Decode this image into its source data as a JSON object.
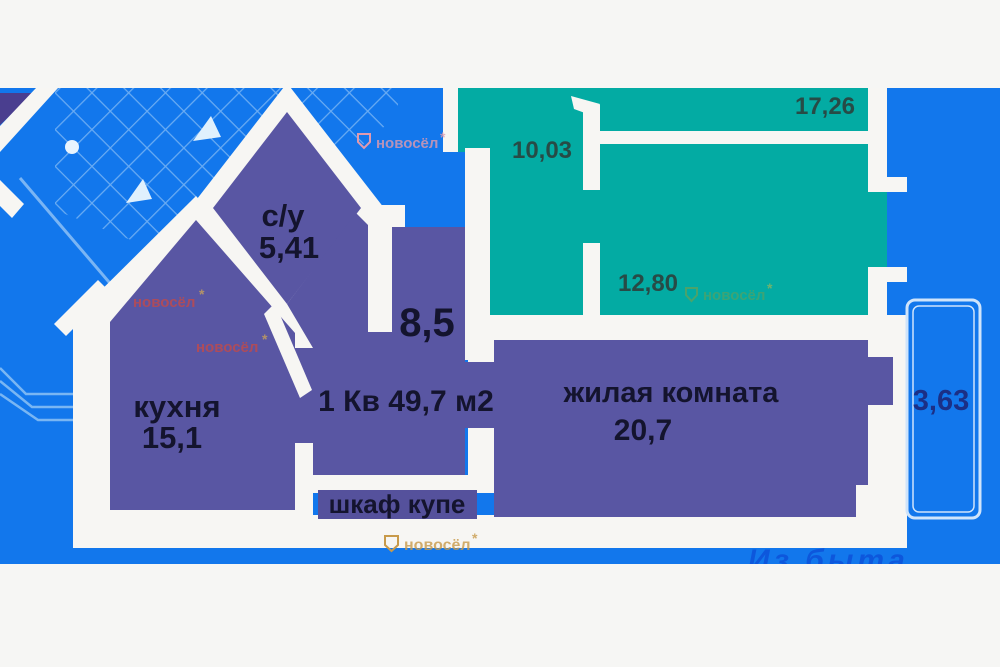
{
  "plan": {
    "apartment_title": "1 Кв 49,7 м2",
    "rooms": {
      "su_name": "с/у",
      "su_area": "5,41",
      "hall_area": "8,5",
      "kitchen_name": "кухня",
      "kitchen_area": "15,1",
      "living_name": "жилая комната",
      "living_area": "20,7",
      "wardrobe_label": "шкаф купе",
      "balcony_area": "3,63"
    },
    "neighbor_rooms": {
      "room_top_left": "10,03",
      "room_top_right": "17,26",
      "room_main": "12,80"
    }
  },
  "watermarks": {
    "brand": "новосёл",
    "brand_star": "*",
    "bottom_script": "Из быта"
  },
  "colors": {
    "background_blue": "#1277ec",
    "room_purple": "#5956a3",
    "neighbor_teal": "#03aba3",
    "wall_white": "#f7f6f3",
    "corner_indigo": "#4a3e8f",
    "hatch_blue": "#7ab5f4"
  }
}
